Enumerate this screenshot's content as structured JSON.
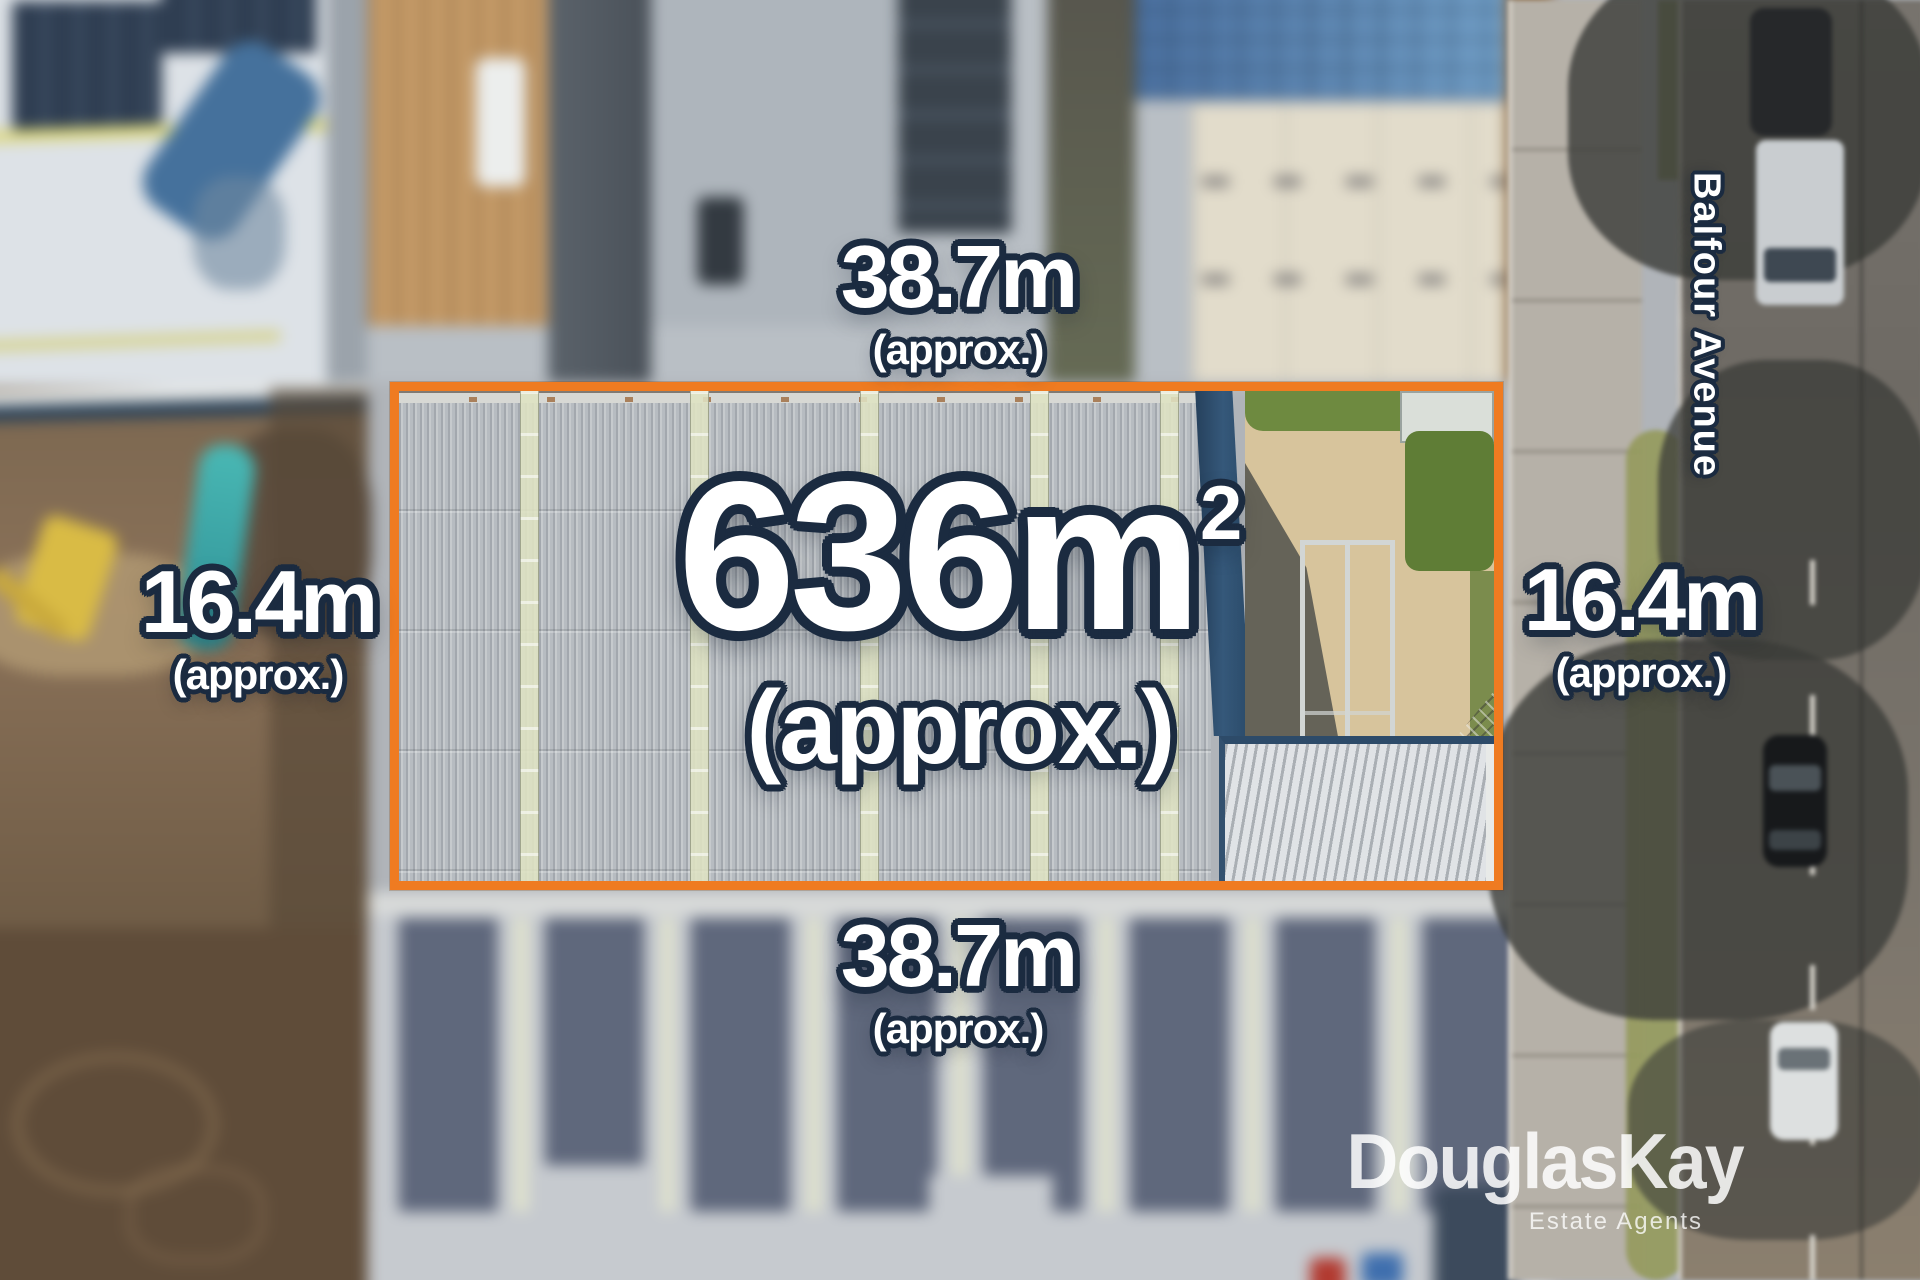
{
  "property": {
    "area": {
      "value": "636m",
      "superscript": "2",
      "qualifier": "(approx.)"
    },
    "dimensions": {
      "top": {
        "value": "38.7m",
        "qualifier": "(approx.)"
      },
      "bottom": {
        "value": "38.7m",
        "qualifier": "(approx.)"
      },
      "left": {
        "value": "16.4m",
        "qualifier": "(approx.)"
      },
      "right": {
        "value": "16.4m",
        "qualifier": "(approx.)"
      }
    }
  },
  "street": {
    "name": "Balfour Avenue"
  },
  "branding": {
    "agency": "DouglasKay",
    "tagline": "Estate Agents"
  },
  "colors": {
    "boundary_orange": "#EF7B21",
    "outline_navy": "#1B2B40",
    "label_white": "#FFFFFF"
  }
}
